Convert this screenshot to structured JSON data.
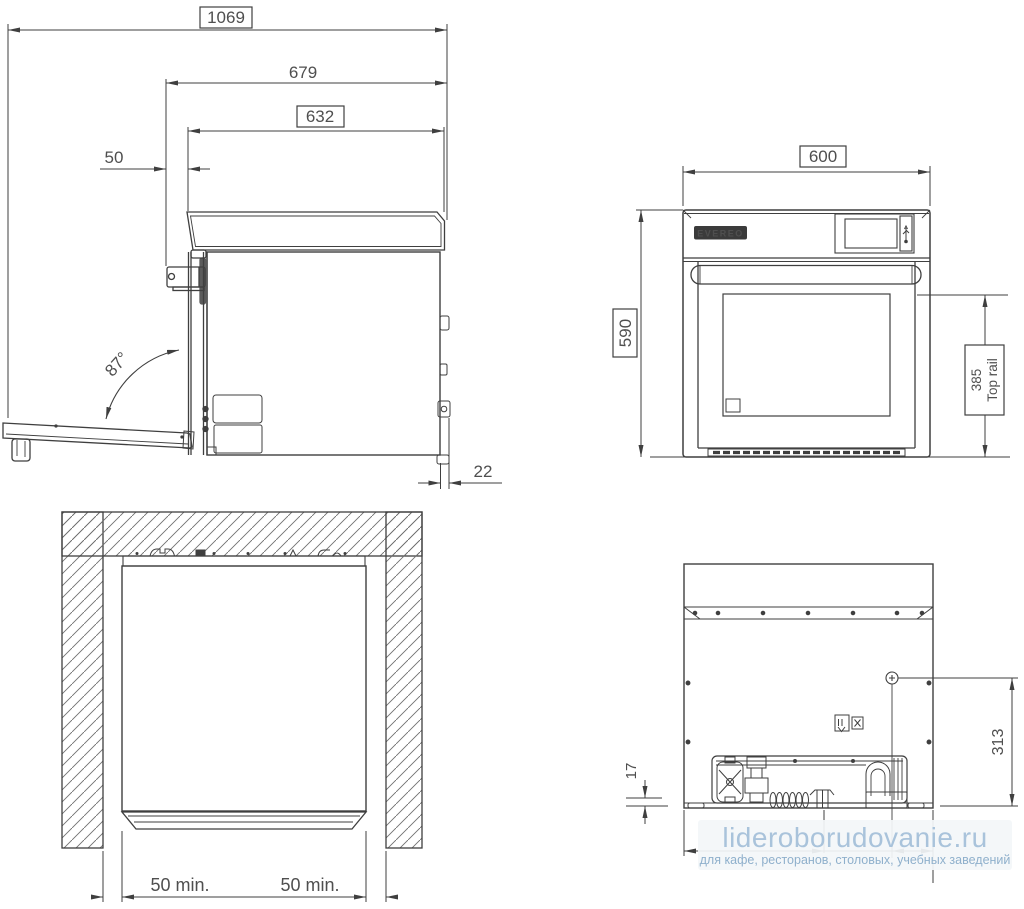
{
  "page": {
    "background": "#ffffff"
  },
  "colors": {
    "line": "#3f3f3f",
    "dim_text": "#4f4f4f",
    "hatch": "#6f6f6f",
    "watermark_title": "#a9c3db",
    "watermark_subtitle": "#8fb0cc",
    "watermark_bg": "#f3f6f9"
  },
  "drawing": {
    "side_view": {
      "dim_total_depth_door_open": "1069",
      "dim_depth_to_handle": "679",
      "dim_body_depth": "632",
      "dim_handle_offset": "50",
      "door_open_angle": "87°",
      "dim_rear_spacer": "22"
    },
    "front_view": {
      "brand": "EVEREO",
      "dim_width": "600",
      "dim_height": "590",
      "dim_top_rail_height": "385",
      "dim_top_rail_caption": "Top rail"
    },
    "top_view": {
      "dim_left_clearance": "50 min.",
      "dim_right_clearance": "50 min."
    },
    "rear_view": {
      "dim_base_gap": "17",
      "dim_connection_height": "313"
    }
  },
  "watermark": {
    "title": "lideroborudovanie.ru",
    "subtitle": "для кафе, ресторанов, столовых, учебных заведений"
  }
}
